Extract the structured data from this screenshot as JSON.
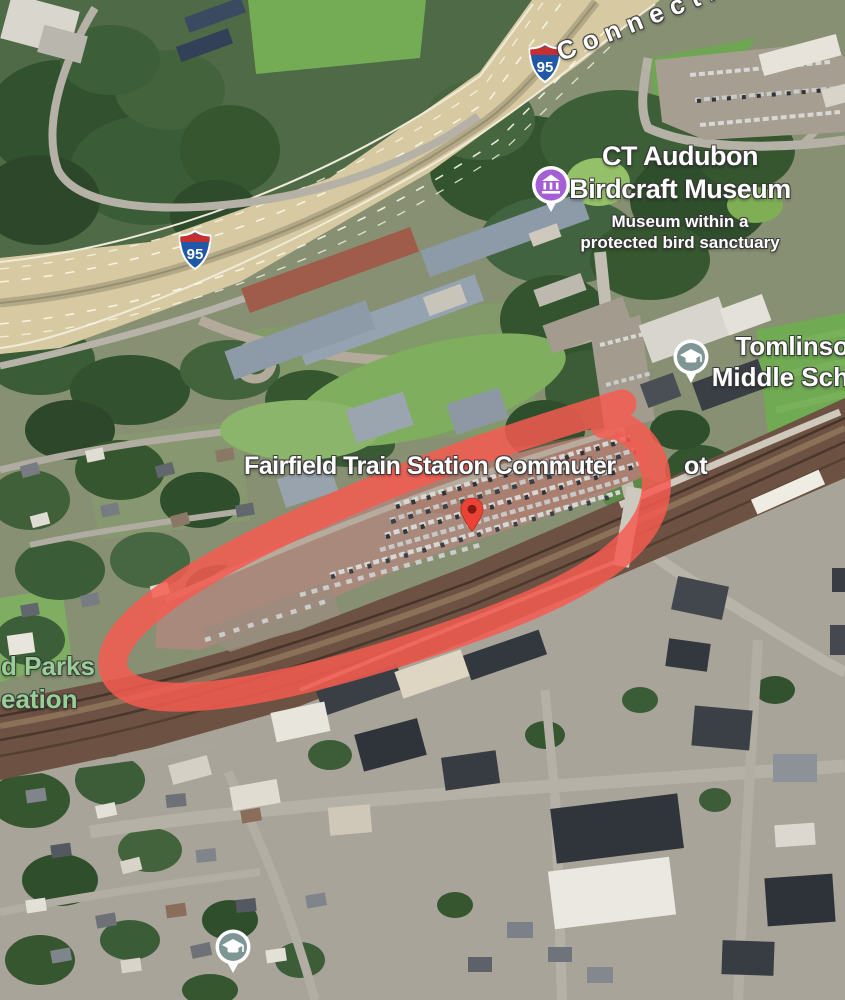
{
  "map_labels": {
    "highway_route": "Connecticut",
    "interstate_shield": "95",
    "museum": {
      "name_line1": "CT Audubon",
      "name_line2": "Birdcraft Museum",
      "description_line1": "Museum within a",
      "description_line2": "protected bird sanctuary"
    },
    "school": {
      "name_line1": "Tomlinso",
      "name_line2": "Middle Sch"
    },
    "commuter_lot": {
      "label_left": "Fairfield Train Station Commuter",
      "label_right": "ot"
    },
    "park": {
      "label_line1": "d Parks",
      "label_line2": "eation"
    }
  },
  "annotation": {
    "loop_color": "#f75b50",
    "pin_color": "#ea4335"
  },
  "icon_colors": {
    "museum_pin": "#a55fd6",
    "school_pin": "#7e9794",
    "shield_blue": "#2057a7",
    "shield_red": "#c62f2f",
    "park_label_green": "#98cf96"
  }
}
